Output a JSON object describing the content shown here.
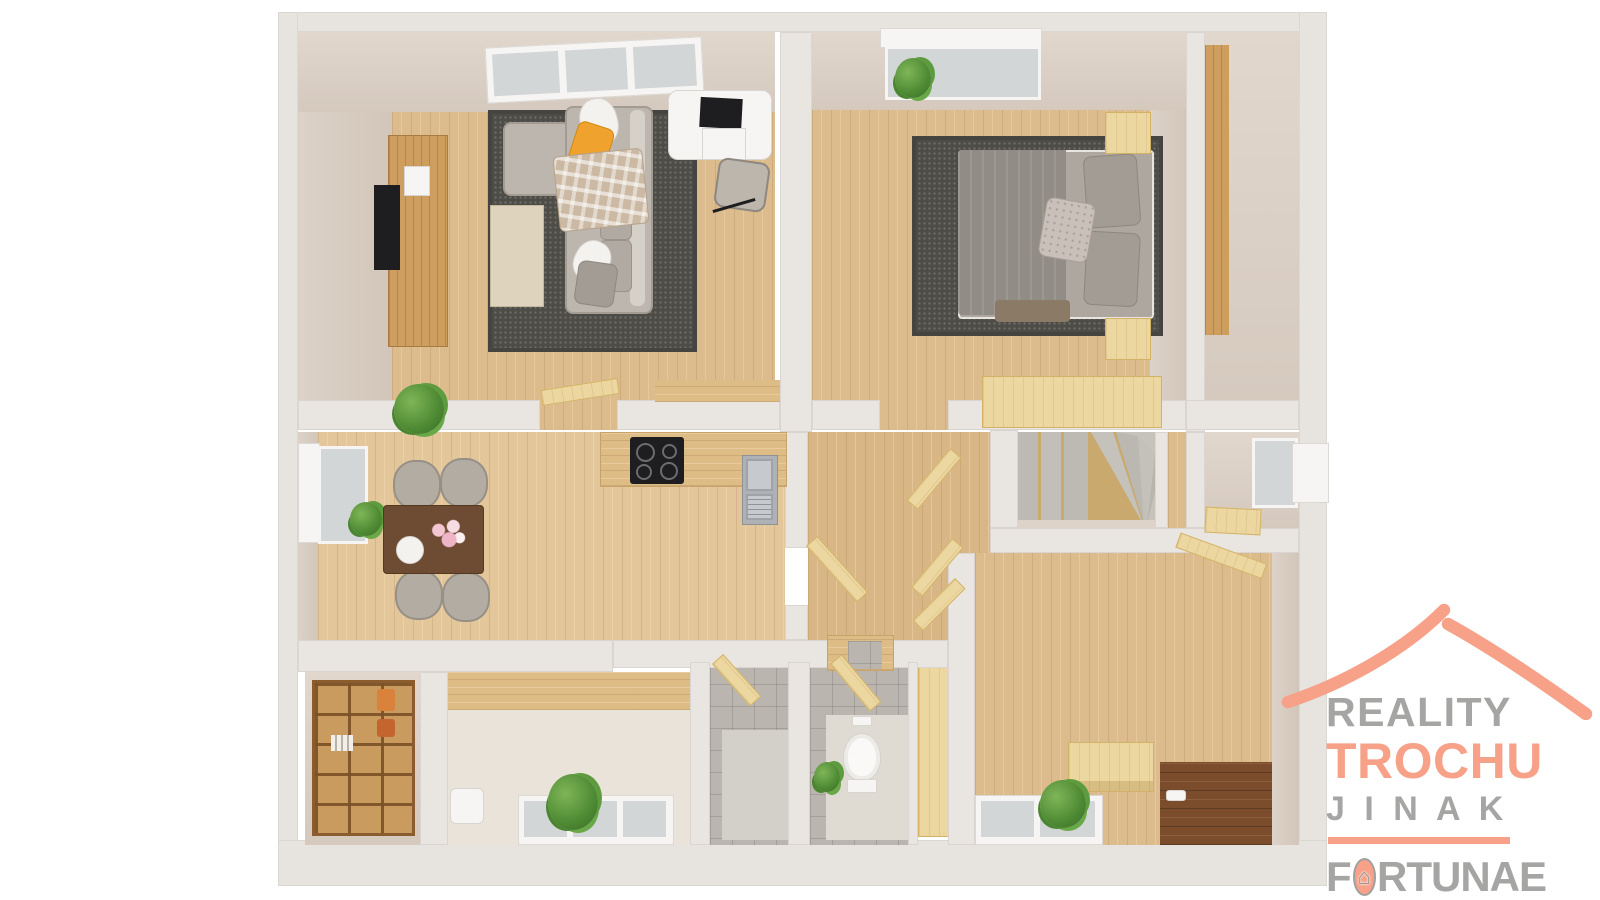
{
  "branding": {
    "reality": "REALITY",
    "trochu": "TROCHU",
    "jinak": "J I N A K",
    "fortunae_f": "F",
    "fortunae_rest": "RTUNAE",
    "house_glyph": "⌂",
    "legal": "s.r.o.",
    "colors": {
      "accent_salmon": "#F7A189",
      "text_gray": "#A5A5A4"
    },
    "icons": [
      "roof-swoosh-icon",
      "house-in-o-icon"
    ]
  },
  "floor_plan": {
    "type": "3d-top-down-floor-plan-render",
    "palette": {
      "outer_wall": "#E7E4E0",
      "inner_wall_face": "#D8CDC3",
      "wood_floor": "#DCBB8D",
      "pale_wood": "#ECD7A0",
      "rug": "#4E4C47",
      "tile": "#BAB6AF",
      "dark_entry_floor": "#7C4D2D",
      "accent_pillow": "#F0A22E"
    },
    "rooms": [
      {
        "name": "living-room",
        "furniture": [
          "skylight-window",
          "tv-cabinet",
          "tv",
          "thermostat",
          "corner-sofa",
          "yellow-pillow",
          "plaid-blanket",
          "area-rug",
          "coffee-table",
          "white-desk",
          "laptop",
          "desk-chair",
          "potted-plant",
          "open-door"
        ]
      },
      {
        "name": "bedroom",
        "furniture": [
          "window",
          "window-plant",
          "double-bed",
          "pillows",
          "accent-pillow",
          "area-rug",
          "nightstand-left",
          "nightstand-right",
          "wardrobe"
        ]
      },
      {
        "name": "closet-room",
        "furniture": [
          "tall-cabinet"
        ]
      },
      {
        "name": "kitchen-dining",
        "furniture": [
          "window",
          "dining-table",
          "four-chairs",
          "flower-vase",
          "plate",
          "kitchen-counter",
          "induction-cooktop",
          "sink"
        ]
      },
      {
        "name": "hallway",
        "furniture": [
          "open-doors",
          "mini-steps"
        ]
      },
      {
        "name": "staircase",
        "furniture": [
          "winder-stairs"
        ]
      },
      {
        "name": "stair-landing-room",
        "furniture": [
          "window",
          "wood-shelf"
        ]
      },
      {
        "name": "storage-room",
        "furniture": [
          "shelving-unit"
        ]
      },
      {
        "name": "bathroom",
        "furniture": [
          "washbasin",
          "window",
          "plant"
        ]
      },
      {
        "name": "shower-room",
        "furniture": [
          "tiled-walls",
          "open-door"
        ]
      },
      {
        "name": "wc",
        "furniture": [
          "toilet",
          "flush-plate",
          "plant",
          "open-door"
        ]
      },
      {
        "name": "entry-hall",
        "furniture": [
          "storage-chest",
          "window",
          "plant",
          "dark-wood-entry-floor",
          "open-door"
        ]
      }
    ]
  }
}
